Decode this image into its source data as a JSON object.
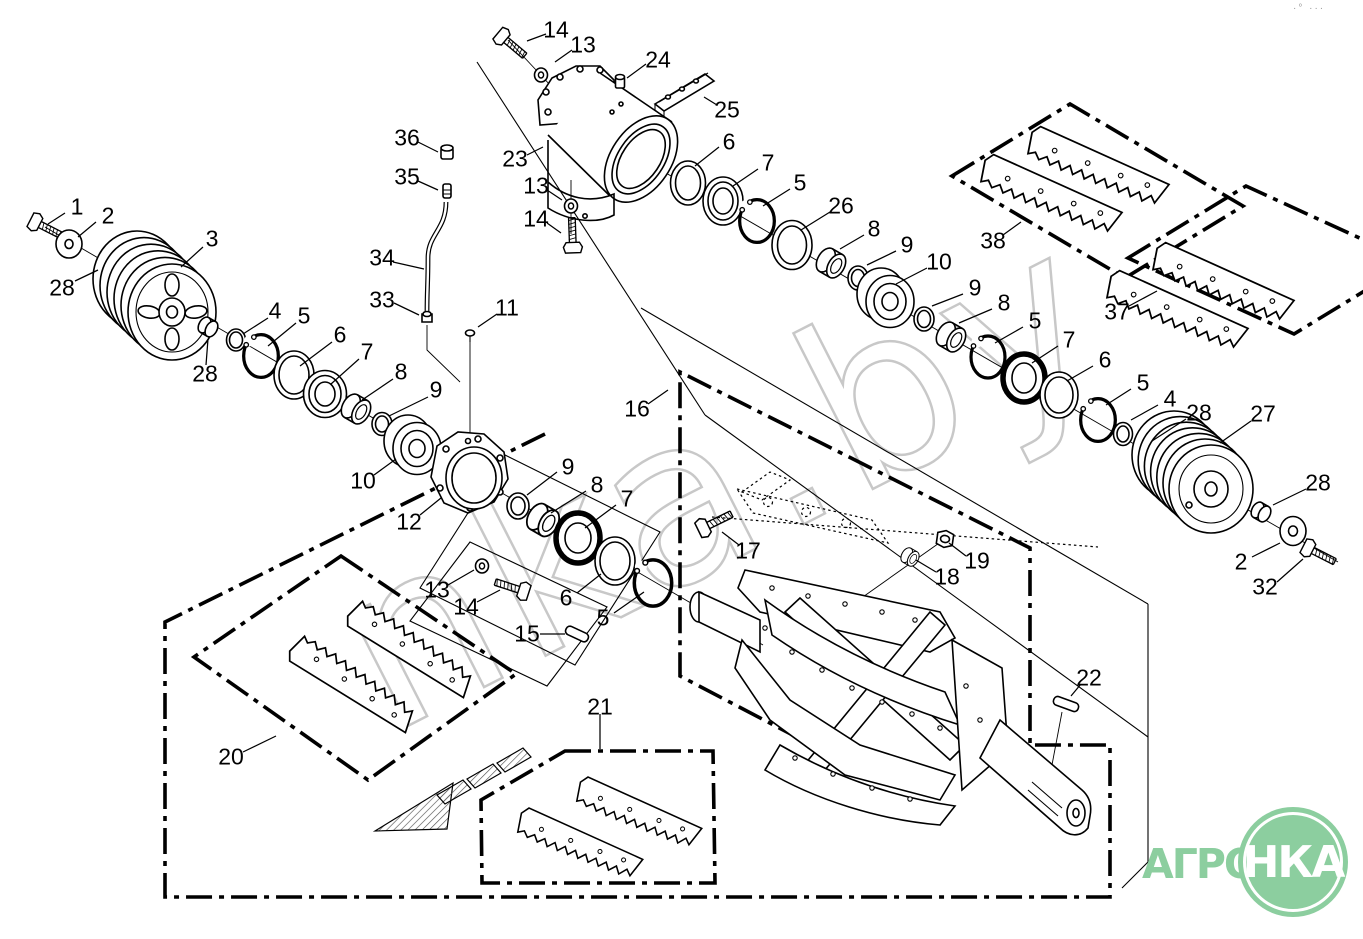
{
  "watermark": "nka.by",
  "corner_marks": "·° ···",
  "logo": {
    "word": "АГРО",
    "circle": "НКА"
  },
  "colors": {
    "logo_green": "#8cce9f",
    "watermark_gray": "#c8c8c8",
    "line": "#000000"
  },
  "callouts": [
    "14",
    "13",
    "24",
    "25",
    "23",
    "36",
    "35",
    "13",
    "14",
    "34",
    "33",
    "11",
    "6",
    "7",
    "5",
    "26",
    "8",
    "9",
    "10",
    "38",
    "37",
    "9",
    "8",
    "5",
    "7",
    "6",
    "5",
    "4",
    "28",
    "27",
    "28",
    "2",
    "32",
    "1",
    "2",
    "28",
    "3",
    "28",
    "4",
    "5",
    "6",
    "7",
    "8",
    "9",
    "10",
    "12",
    "9",
    "8",
    "7",
    "6",
    "5",
    "13",
    "14",
    "15",
    "16",
    "17",
    "18",
    "19",
    "22",
    "21",
    "20"
  ]
}
